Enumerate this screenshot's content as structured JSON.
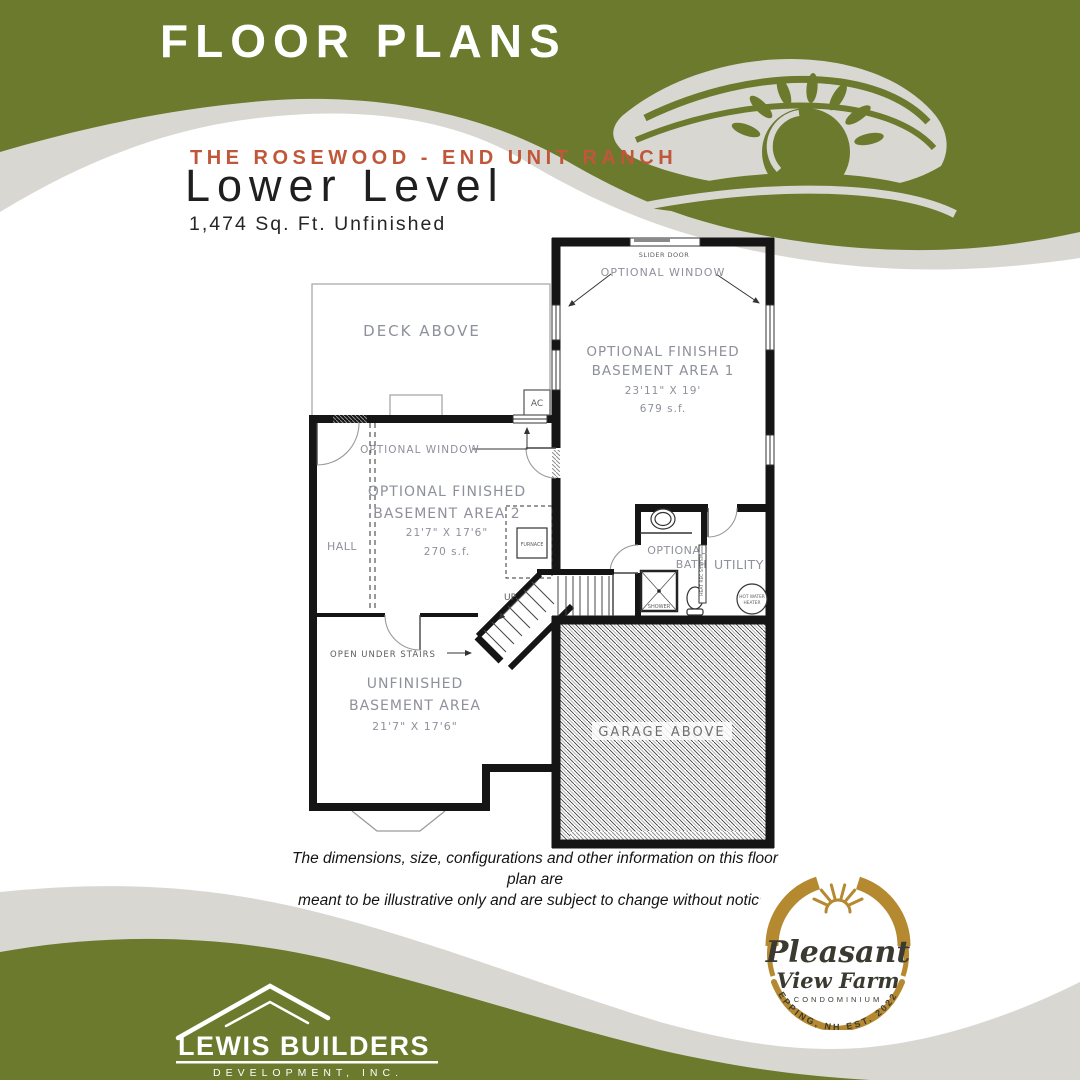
{
  "colors": {
    "olive_green": "#6b7a2d",
    "wave_gray": "#d9d7d2",
    "accent_red": "#c0573a",
    "logo_gold": "#b5892f",
    "logo_dark": "#3b3a31"
  },
  "banner": {
    "title": "FLOOR PLANS"
  },
  "header": {
    "series": "THE ROSEWOOD - END UNIT RANCH",
    "level": "Lower Level",
    "area": "1,474 Sq. Ft. Unfinished"
  },
  "plan": {
    "slider_door": "SLIDER DOOR",
    "optional_window": "OPTIONAL WINDOW",
    "area1_line1": "OPTIONAL FINISHED",
    "area1_line2": "BASEMENT AREA 1",
    "area1_dims": "23'11\" X 19'",
    "area1_sqft": "679 s.f.",
    "deck": "DECK ABOVE",
    "ac": "AC",
    "optional_window2": "OPTIONAL WINDOW",
    "area2_line1": "OPTIONAL FINISHED",
    "area2_line2": "BASEMENT AREA 2",
    "area2_dims": "21'7\" X 17'6\"",
    "area2_sqft": "270 s.f.",
    "hall": "HALL",
    "furnace": "FURNACE",
    "bath_line1": "OPTIONAL",
    "bath_line2": "BATH",
    "utility": "UTILITY",
    "hwh_line1": "HOT WATER",
    "hwh_line2": "HEATER",
    "hrv": "HEAT REC SYSTEM",
    "shower": "SHOWER",
    "up": "UP",
    "open_under_stairs": "OPEN UNDER STAIRS",
    "unf_line1": "UNFINISHED",
    "unf_line2": "BASEMENT AREA",
    "unf_dims": "21'7\" X 17'6\"",
    "garage": "GARAGE ABOVE"
  },
  "disclaimer": {
    "line1": "The dimensions, size, configurations and other information on this floor plan are",
    "line2": "meant to be illustrative only and are subject to change without notice."
  },
  "farm_logo": {
    "name1": "Pleasant",
    "name2": "View Farm",
    "sub": "CONDOMINIUM",
    "arc": "EPPING, NH EST. 2022"
  },
  "builder_logo": {
    "name": "LEWIS BUILDERS",
    "sub": "DEVELOPMENT, INC."
  }
}
